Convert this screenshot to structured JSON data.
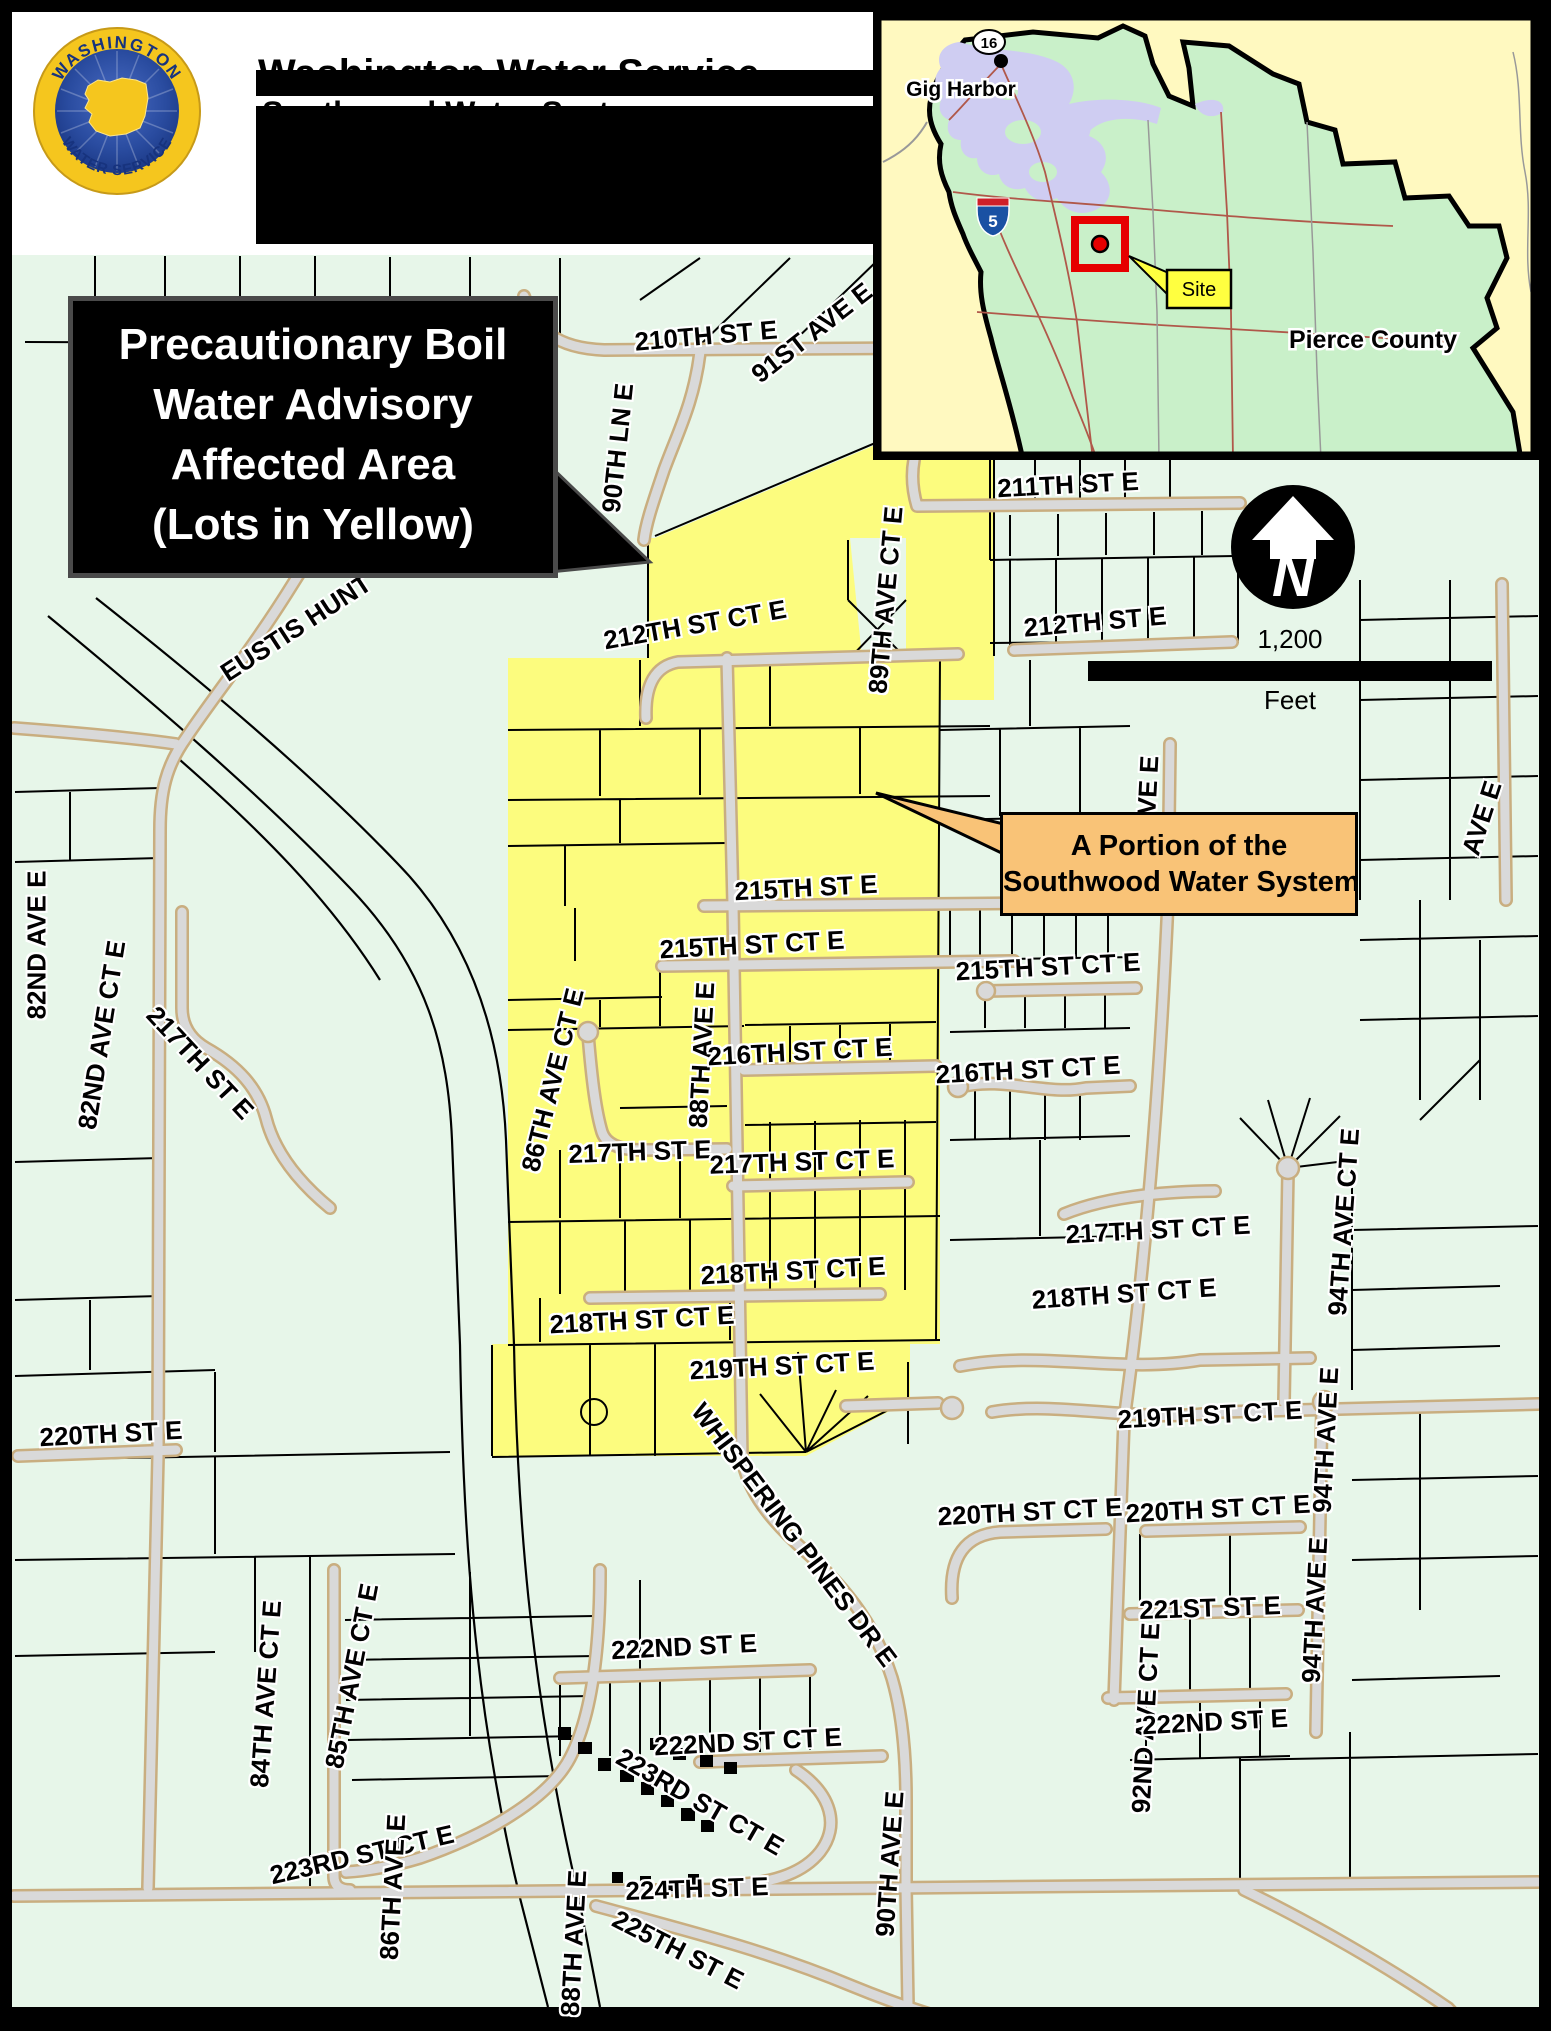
{
  "header": {
    "title_line1": "Washington Water Service",
    "title_line2": "Southwood Water System",
    "logo": {
      "arc_top": "WASHINGTON",
      "arc_bottom": "WATER SERVICE"
    }
  },
  "callouts": {
    "advisory": {
      "lines": [
        "Precautionary Boil",
        "Water Advisory",
        "Affected Area",
        "(Lots in Yellow)"
      ],
      "bg": "#000000",
      "text_color": "#FFFFFF"
    },
    "system": {
      "lines": [
        "A Portion of the",
        "Southwood Water System"
      ],
      "bg": "#F9C377",
      "text_color": "#000000"
    }
  },
  "inset": {
    "labels": {
      "city": "Gig Harbor",
      "county": "Pierce County",
      "site": "Site",
      "route_16": "16",
      "interstate_5": "5"
    },
    "colors": {
      "land": "#C9F0C9",
      "water": "#CFCDF2",
      "outside": "#FFF9C0",
      "site_red": "#E60000",
      "site_yellow": "#FFFF40"
    }
  },
  "compass": {
    "letter": "N"
  },
  "scale_bar": {
    "distance": "1,200",
    "unit": "Feet"
  },
  "map": {
    "affected_color": "#FCFC7E",
    "street_labels": [
      {
        "t": "210TH ST E",
        "x": 706,
        "y": 336,
        "r": -5
      },
      {
        "t": "91ST AVE E",
        "x": 812,
        "y": 333,
        "r": -38
      },
      {
        "t": "90TH LN E",
        "x": 618,
        "y": 448,
        "r": -84
      },
      {
        "t": "211TH ST E",
        "x": 1068,
        "y": 485,
        "r": -3
      },
      {
        "t": "212TH ST CT E",
        "x": 695,
        "y": 625,
        "r": -10
      },
      {
        "t": "89TH AVE CT E",
        "x": 886,
        "y": 600,
        "r": -85
      },
      {
        "t": "212TH ST E",
        "x": 1095,
        "y": 622,
        "r": -5
      },
      {
        "t": "EUSTIS HUNT",
        "x": 296,
        "y": 628,
        "r": -33
      },
      {
        "t": "215TH ST E",
        "x": 806,
        "y": 888,
        "r": -3
      },
      {
        "t": "215TH ST CT E",
        "x": 752,
        "y": 945,
        "r": -3
      },
      {
        "t": "215TH ST CT E",
        "x": 1048,
        "y": 967,
        "r": -3
      },
      {
        "t": "86TH AVE CT E",
        "x": 553,
        "y": 1080,
        "r": -76
      },
      {
        "t": "88TH AVE E",
        "x": 702,
        "y": 1055,
        "r": -87
      },
      {
        "t": "216TH ST CT E",
        "x": 800,
        "y": 1052,
        "r": -3
      },
      {
        "t": "216TH ST CT E",
        "x": 1028,
        "y": 1070,
        "r": -3
      },
      {
        "t": "217TH ST E",
        "x": 640,
        "y": 1152,
        "r": -2
      },
      {
        "t": "217TH ST CT E",
        "x": 802,
        "y": 1162,
        "r": -2
      },
      {
        "t": "217TH ST CT E",
        "x": 1158,
        "y": 1230,
        "r": -3
      },
      {
        "t": "82ND AVE E",
        "x": 37,
        "y": 945,
        "r": -90
      },
      {
        "t": "82ND AVE CT E",
        "x": 102,
        "y": 1035,
        "r": -81
      },
      {
        "t": "217TH ST E",
        "x": 200,
        "y": 1063,
        "r": 47
      },
      {
        "t": "218TH ST CT E",
        "x": 793,
        "y": 1271,
        "r": -3
      },
      {
        "t": "218TH ST CT E",
        "x": 642,
        "y": 1320,
        "r": -3
      },
      {
        "t": "218TH ST CT E",
        "x": 1124,
        "y": 1294,
        "r": -4
      },
      {
        "t": "219TH ST CT E",
        "x": 782,
        "y": 1366,
        "r": -3
      },
      {
        "t": "219TH ST CT E",
        "x": 1210,
        "y": 1415,
        "r": -3
      },
      {
        "t": "94TH AVE CT E",
        "x": 1344,
        "y": 1222,
        "r": -86
      },
      {
        "t": "220TH ST E",
        "x": 111,
        "y": 1434,
        "r": -3
      },
      {
        "t": "220TH ST CT E",
        "x": 1030,
        "y": 1512,
        "r": -3
      },
      {
        "t": "220TH ST CT E",
        "x": 1218,
        "y": 1509,
        "r": -3
      },
      {
        "t": "94TH AVE E",
        "x": 1326,
        "y": 1440,
        "r": -87
      },
      {
        "t": "94TH AVE E",
        "x": 1315,
        "y": 1610,
        "r": -87
      },
      {
        "t": "221ST ST E",
        "x": 1210,
        "y": 1608,
        "r": -2
      },
      {
        "t": "WHISPERING PINES DR E",
        "x": 794,
        "y": 1535,
        "r": 53
      },
      {
        "t": "92ND AVE CT E",
        "x": 1146,
        "y": 1718,
        "r": -87
      },
      {
        "t": "92ND AVE E",
        "x": 1146,
        "y": 830,
        "r": -87
      },
      {
        "t": "222ND ST E",
        "x": 684,
        "y": 1647,
        "r": -3
      },
      {
        "t": "222ND ST E",
        "x": 1215,
        "y": 1722,
        "r": -3
      },
      {
        "t": "222ND ST CT E",
        "x": 748,
        "y": 1742,
        "r": -3
      },
      {
        "t": "223RD ST CT E",
        "x": 700,
        "y": 1802,
        "r": 30
      },
      {
        "t": "223RD ST CT E",
        "x": 362,
        "y": 1855,
        "r": -13
      },
      {
        "t": "84TH AVE CT E",
        "x": 266,
        "y": 1694,
        "r": -86
      },
      {
        "t": "85TH AVE CT E",
        "x": 352,
        "y": 1676,
        "r": -79
      },
      {
        "t": "86TH AVE E",
        "x": 393,
        "y": 1887,
        "r": -87
      },
      {
        "t": "88TH AVE E",
        "x": 574,
        "y": 1943,
        "r": -87
      },
      {
        "t": "90TH AVE E",
        "x": 890,
        "y": 1864,
        "r": -86
      },
      {
        "t": "224TH ST E",
        "x": 697,
        "y": 1889,
        "r": -2
      },
      {
        "t": "225TH ST E",
        "x": 678,
        "y": 1950,
        "r": 27
      },
      {
        "t": "AVE E",
        "x": 1482,
        "y": 818,
        "r": -72
      }
    ]
  }
}
